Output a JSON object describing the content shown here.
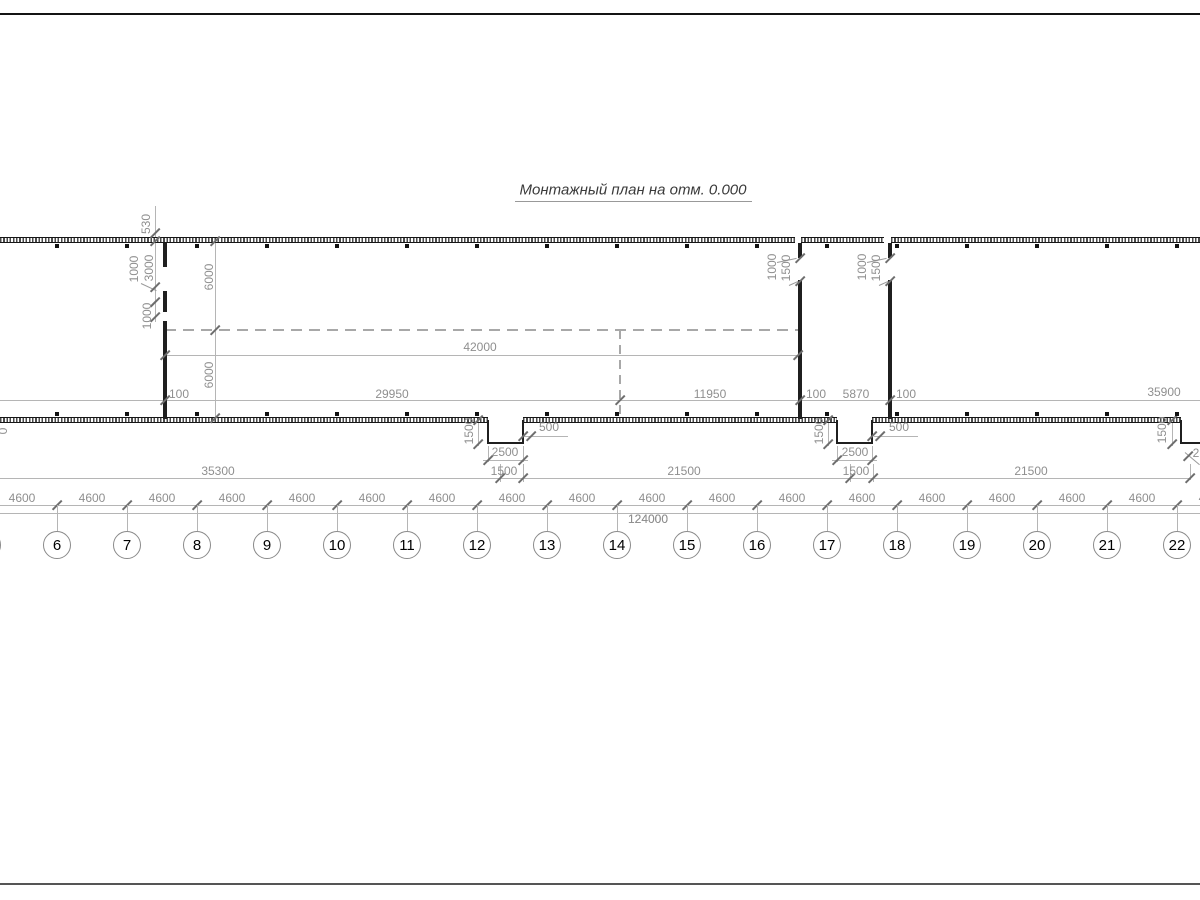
{
  "title": {
    "text": "Монтажный план на отм. 0.000"
  },
  "colors": {
    "wall": "#1f1f1f",
    "dim_line": "#b5b5b5",
    "dim_text": "#8f8f8f",
    "tick": "#6e6e6e",
    "axis_text": "#000000",
    "title_text": "#3a3a3a",
    "dashed": "#a8a8a8"
  },
  "axes": {
    "numbers": [
      "6",
      "7",
      "8",
      "9",
      "10",
      "11",
      "12",
      "13",
      "14",
      "15",
      "16",
      "17",
      "18",
      "19",
      "20",
      "21",
      "22"
    ],
    "start_x": 57,
    "spacing": 70,
    "circle_y": 545,
    "tick_line_y": 505,
    "ext_y1": 505,
    "ext_y2": 531,
    "square_top_y": 244,
    "square_bottom_y": 412,
    "partial_left_circle_x": -13,
    "spacing_label": "4600",
    "spacing_label_y": 498,
    "total_label": "124000",
    "total_label_x": 648,
    "total_label_y": 519
  },
  "wall_bands": {
    "top": [
      {
        "x": 0,
        "y": 237,
        "w": 795
      },
      {
        "x": 801,
        "y": 237,
        "w": 83
      },
      {
        "x": 891,
        "y": 237,
        "w": 309
      }
    ],
    "bottom": [
      {
        "x": 0,
        "y": 417,
        "w": 488
      },
      {
        "x": 523,
        "y": 417,
        "w": 314
      },
      {
        "x": 872,
        "y": 417,
        "w": 309
      }
    ]
  },
  "wall_rects": [
    {
      "x": 163,
      "y": 243,
      "w": 4,
      "h": 24
    },
    {
      "x": 163,
      "y": 291,
      "w": 4,
      "h": 21
    },
    {
      "x": 163,
      "y": 321,
      "w": 4,
      "h": 98
    },
    {
      "x": 798,
      "y": 243,
      "w": 4,
      "h": 15
    },
    {
      "x": 798,
      "y": 280,
      "w": 4,
      "h": 139
    },
    {
      "x": 888,
      "y": 243,
      "w": 4,
      "h": 15
    },
    {
      "x": 888,
      "y": 280,
      "w": 4,
      "h": 139
    },
    {
      "x": 487,
      "y": 420,
      "w": 2,
      "h": 24
    },
    {
      "x": 522,
      "y": 420,
      "w": 2,
      "h": 24
    },
    {
      "x": 487,
      "y": 442,
      "w": 37,
      "h": 2
    },
    {
      "x": 836,
      "y": 420,
      "w": 2,
      "h": 24
    },
    {
      "x": 871,
      "y": 420,
      "w": 2,
      "h": 24
    },
    {
      "x": 836,
      "y": 442,
      "w": 37,
      "h": 2
    },
    {
      "x": 1180,
      "y": 420,
      "w": 2,
      "h": 24
    },
    {
      "x": 1180,
      "y": 442,
      "w": 20,
      "h": 2
    }
  ],
  "solid_lines": [
    {
      "x": 0,
      "y": 14,
      "w": 1200,
      "t": 1.6,
      "c": "#141414"
    },
    {
      "x": 0,
      "y": 884,
      "w": 1200,
      "t": 2,
      "c": "#555555"
    },
    {
      "x": 515,
      "y": 201,
      "w": 237,
      "c": "#999999"
    },
    {
      "x": 155,
      "y": 206,
      "h": 116
    },
    {
      "x": 215,
      "y": 241,
      "h": 177
    },
    {
      "x": 165,
      "y": 355,
      "w": 633
    },
    {
      "x": 0,
      "y": 400,
      "w": 1200
    },
    {
      "x": 0,
      "y": 478,
      "w": 1190
    },
    {
      "x": 0,
      "y": 505,
      "w": 1200
    },
    {
      "x": 0,
      "y": 513,
      "w": 1200
    },
    {
      "x": 478,
      "y": 418,
      "h": 28
    },
    {
      "x": 524,
      "y": 436,
      "w": 44
    },
    {
      "x": 483,
      "y": 460,
      "w": 45
    },
    {
      "x": 828,
      "y": 418,
      "h": 28
    },
    {
      "x": 874,
      "y": 436,
      "w": 44
    },
    {
      "x": 832,
      "y": 460,
      "w": 45
    },
    {
      "x": 1172,
      "y": 418,
      "h": 28
    },
    {
      "x": 500,
      "y": 464,
      "h": 18
    },
    {
      "x": 523,
      "y": 464,
      "h": 18
    },
    {
      "x": 850,
      "y": 464,
      "h": 18
    },
    {
      "x": 873,
      "y": 464,
      "h": 18
    },
    {
      "x": 488,
      "y": 446,
      "h": 16
    },
    {
      "x": 523,
      "y": 446,
      "h": 16
    },
    {
      "x": 837,
      "y": 446,
      "h": 16
    },
    {
      "x": 872,
      "y": 446,
      "h": 16
    },
    {
      "x": 1190,
      "y": 464,
      "h": 16
    }
  ],
  "dashed_lines": [
    {
      "x": 165,
      "y": 330,
      "w": 633
    },
    {
      "x": 620,
      "y": 330,
      "h": 84
    }
  ],
  "diag_lines": [
    {
      "x": 141,
      "y": 283,
      "len": 17,
      "a": 25
    },
    {
      "x": 150,
      "y": 306,
      "len": 9,
      "a": -45
    },
    {
      "x": 777,
      "y": 262,
      "len": 20,
      "a": -12
    },
    {
      "x": 789,
      "y": 285,
      "len": 10,
      "a": -24
    },
    {
      "x": 867,
      "y": 262,
      "len": 20,
      "a": -12
    },
    {
      "x": 879,
      "y": 285,
      "len": 10,
      "a": -24
    },
    {
      "x": 1185,
      "y": 452,
      "len": 19,
      "a": 40
    }
  ],
  "ticks": [
    {
      "x": 155,
      "y": 233
    },
    {
      "x": 155,
      "y": 241
    },
    {
      "x": 155,
      "y": 287
    },
    {
      "x": 155,
      "y": 302
    },
    {
      "x": 155,
      "y": 317
    },
    {
      "x": 215,
      "y": 241
    },
    {
      "x": 215,
      "y": 330
    },
    {
      "x": 215,
      "y": 418
    },
    {
      "x": 165,
      "y": 355
    },
    {
      "x": 798,
      "y": 355
    },
    {
      "x": 165,
      "y": 400
    },
    {
      "x": 620,
      "y": 400
    },
    {
      "x": 800,
      "y": 400
    },
    {
      "x": 890,
      "y": 400
    },
    {
      "x": 800,
      "y": 258
    },
    {
      "x": 800,
      "y": 281
    },
    {
      "x": 890,
      "y": 258
    },
    {
      "x": 890,
      "y": 281
    },
    {
      "x": 478,
      "y": 420
    },
    {
      "x": 478,
      "y": 444
    },
    {
      "x": 828,
      "y": 420
    },
    {
      "x": 828,
      "y": 444
    },
    {
      "x": 1172,
      "y": 420
    },
    {
      "x": 1172,
      "y": 444
    },
    {
      "x": 523,
      "y": 436
    },
    {
      "x": 531,
      "y": 436
    },
    {
      "x": 872,
      "y": 436
    },
    {
      "x": 880,
      "y": 436
    },
    {
      "x": 488,
      "y": 460
    },
    {
      "x": 523,
      "y": 460
    },
    {
      "x": 837,
      "y": 460
    },
    {
      "x": 872,
      "y": 460
    },
    {
      "x": 500,
      "y": 478
    },
    {
      "x": 523,
      "y": 478
    },
    {
      "x": 850,
      "y": 478
    },
    {
      "x": 873,
      "y": 478
    },
    {
      "x": 1190,
      "y": 478
    },
    {
      "x": 1188,
      "y": 456
    }
  ],
  "dim_labels": [
    {
      "text": "42000",
      "x": 480,
      "y": 347
    },
    {
      "text": "100",
      "x": 179,
      "y": 394
    },
    {
      "text": "29950",
      "x": 392,
      "y": 394
    },
    {
      "text": "11950",
      "x": 710,
      "y": 394
    },
    {
      "text": "100",
      "x": 816,
      "y": 394
    },
    {
      "text": "5870",
      "x": 856,
      "y": 394
    },
    {
      "text": "100",
      "x": 906,
      "y": 394
    },
    {
      "text": "35900",
      "x": 1164,
      "y": 392
    },
    {
      "text": "500",
      "x": 549,
      "y": 427
    },
    {
      "text": "2500",
      "x": 505,
      "y": 452
    },
    {
      "text": "500",
      "x": 899,
      "y": 427
    },
    {
      "text": "2500",
      "x": 855,
      "y": 452
    },
    {
      "text": "35300",
      "x": 218,
      "y": 471
    },
    {
      "text": "1500",
      "x": 504,
      "y": 471
    },
    {
      "text": "21500",
      "x": 684,
      "y": 471
    },
    {
      "text": "1500",
      "x": 856,
      "y": 471
    },
    {
      "text": "21500",
      "x": 1031,
      "y": 471
    },
    {
      "text": "2",
      "x": 1196,
      "y": 453
    },
    {
      "text": "124000",
      "x": 648,
      "y": 519
    }
  ],
  "dim_labels_rotated": [
    {
      "text": "530",
      "x": 146,
      "y": 224
    },
    {
      "text": "1000",
      "x": 134,
      "y": 269
    },
    {
      "text": "3000",
      "x": 149,
      "y": 268
    },
    {
      "text": "1000",
      "x": 147,
      "y": 316
    },
    {
      "text": "6000",
      "x": 209,
      "y": 277
    },
    {
      "text": "6000",
      "x": 209,
      "y": 375
    },
    {
      "text": "1000",
      "x": 772,
      "y": 267
    },
    {
      "text": "1500",
      "x": 786,
      "y": 268
    },
    {
      "text": "1000",
      "x": 862,
      "y": 267
    },
    {
      "text": "1500",
      "x": 876,
      "y": 268
    },
    {
      "text": "1500",
      "x": 469,
      "y": 431
    },
    {
      "text": "1500",
      "x": 819,
      "y": 431
    },
    {
      "text": "1500",
      "x": 1162,
      "y": 430
    },
    {
      "text": "0",
      "x": 3,
      "y": 431
    }
  ]
}
